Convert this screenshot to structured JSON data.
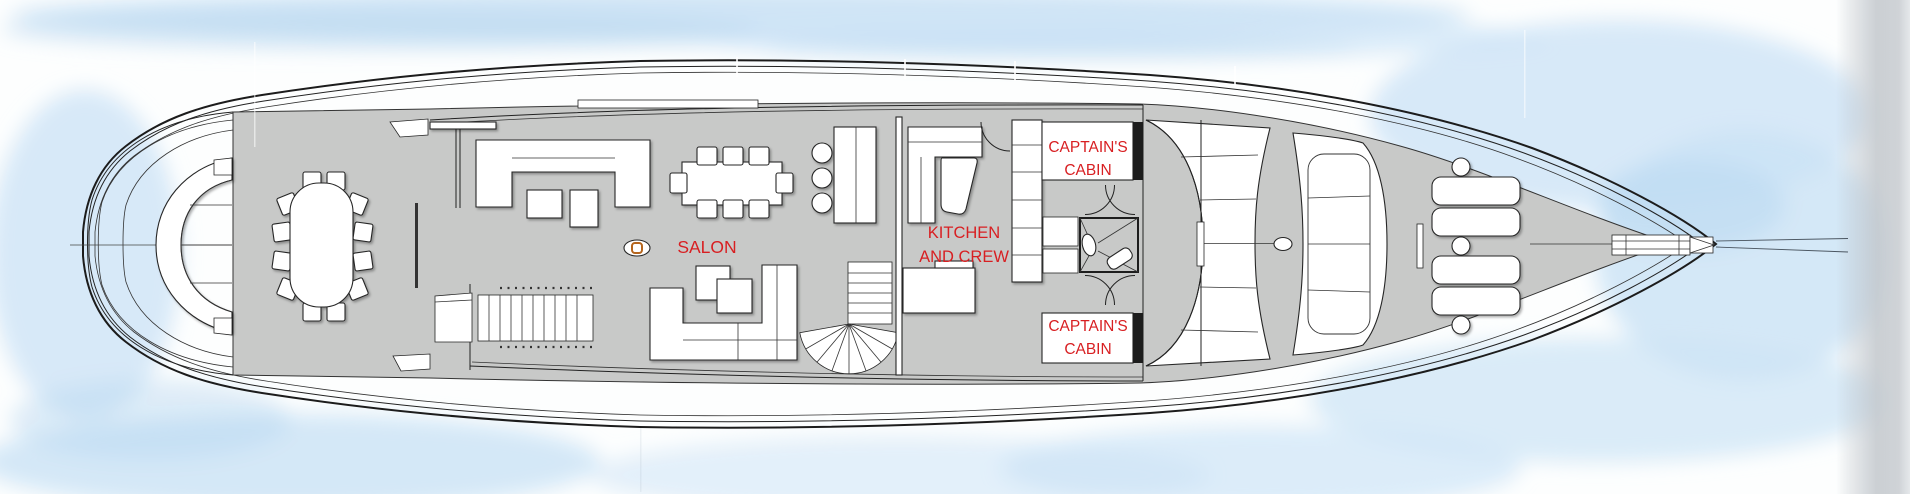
{
  "labels": {
    "salon": "SALON",
    "kitchen_crew": {
      "line1": "KITCHEN",
      "line2": "AND CREW"
    },
    "captains_cabin_fwd": {
      "line1": "CAPTAIN'S",
      "line2": "CABIN"
    },
    "captains_cabin_aft": {
      "line1": "CAPTAIN'S",
      "line2": "CABIN"
    }
  },
  "colors": {
    "label_red": "#d81f22",
    "deck_gray": "#c8c9c8",
    "water_blue": "#cde4f6",
    "water_blue_deep": "#b9d8f0",
    "hull_line": "#1c1c1c",
    "accent_orange": "#b5651d"
  }
}
